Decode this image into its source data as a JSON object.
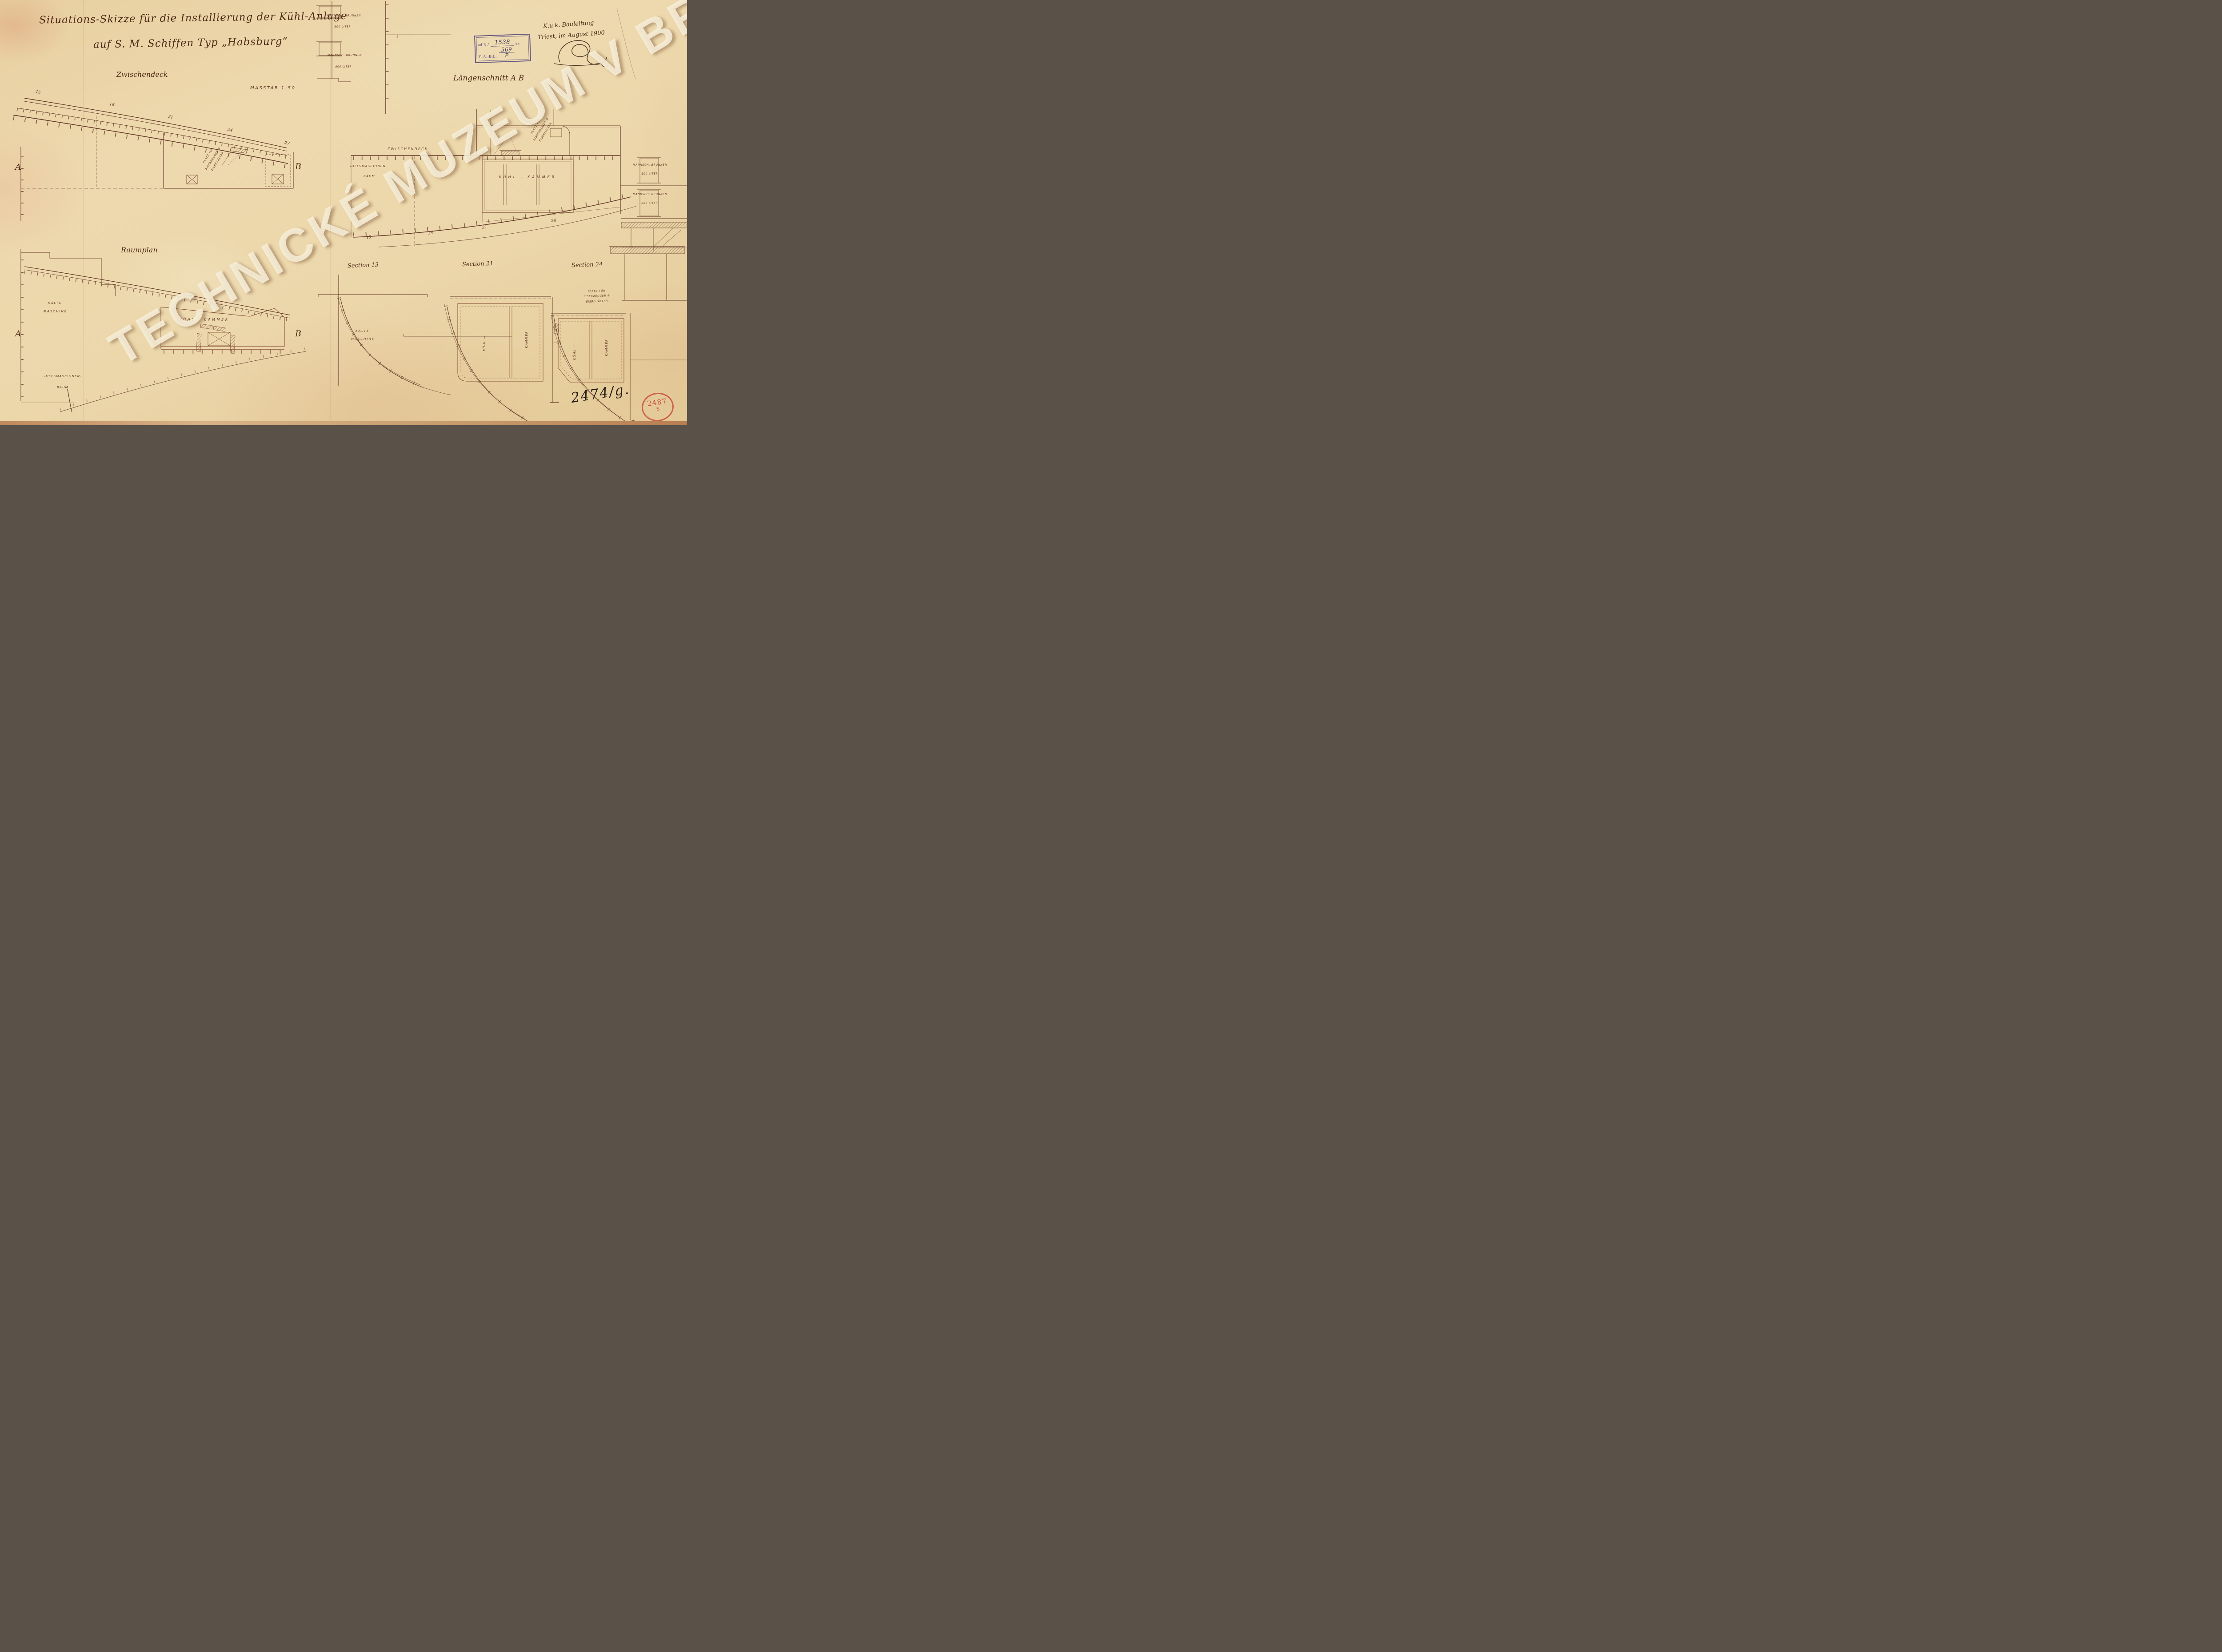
{
  "watermark_text": "TECHNICKÉ MUZEUM V BRNĚ",
  "title": {
    "line1": "Situations-Skizze für die Installierung der Kühl-Anlage",
    "line2": "auf S. M. Schiffen Typ „Habsburg“"
  },
  "views": {
    "zwischendeck": "Zwischendeck",
    "masstab": "MASSTAB 1:50",
    "laengenschnitt": "Längenschnitt A B",
    "raumplan": "Raumplan",
    "section13": "Section 13",
    "section21": "Section 21",
    "section24": "Section 24"
  },
  "marks": {
    "a": "A",
    "b": "B"
  },
  "labels": {
    "mannsch_brunnen": "MANNSCH. BRUNNEN",
    "liter_800": "800 LITER",
    "zwischendeck_deck": "ZWISCHENDECK",
    "hilfsmaschinen": "HILFSMASCHINEN-",
    "raum": "RAUM",
    "kuehl_kammer": "KÜHL - KAMMER",
    "kuehl": "KÜHL —",
    "kammer": "KAMMER",
    "kaelte": "KÄLTE",
    "maschine": "MASCHINE",
    "platz1": "PLATZ FÜR",
    "platz2": "EISERZEUGER &",
    "platz3": "EISBEHÄLTER"
  },
  "frames": {
    "zw": [
      "15",
      "18",
      "21",
      "24",
      "27"
    ],
    "ls": [
      "15",
      "18",
      "21",
      "24"
    ]
  },
  "office_stamp": {
    "ad_no": "ad N.º",
    "no_value": "1538",
    "ex": "ex",
    "tabl": "T. A.-B.L.",
    "tabl_num": "569",
    "tabl_den": "P"
  },
  "handwriting": {
    "office": "K.u.k. Bauleitung",
    "place_date": "Triest, im August 1900",
    "inventory": "2474/g."
  },
  "round_stamp": {
    "number": "2487",
    "letter": "S"
  },
  "colors": {
    "ink": "#5d3222",
    "room_ink": "#7a4128",
    "purple_stamp": "#4f4276",
    "red_stamp": "#c6463b",
    "paper": "#ecd6a9",
    "watermark": "#f6eed7"
  }
}
